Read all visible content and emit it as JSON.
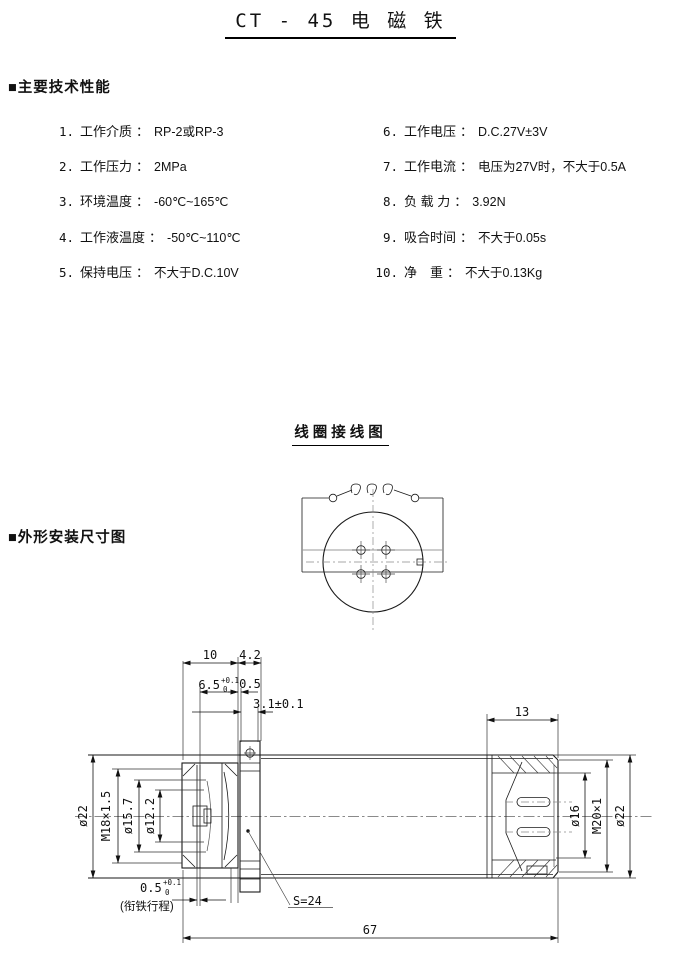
{
  "page": {
    "title": "CT - 45 电 磁 铁"
  },
  "headings": {
    "specs": "■主要技术性能",
    "coil": "线圈接线图",
    "outline": "■外形安装尺寸图"
  },
  "specs": {
    "colon": "：",
    "left": [
      {
        "num": "1.",
        "label": "工作介质",
        "value": "RP-2或RP-3"
      },
      {
        "num": "2.",
        "label": "工作压力",
        "value": "2MPa"
      },
      {
        "num": "3.",
        "label": "环境温度",
        "value": "-60℃~165℃"
      },
      {
        "num": "4.",
        "label": "工作液温度",
        "value": "-50℃~110℃"
      },
      {
        "num": "5.",
        "label": "保持电压",
        "value": "不大于D.C.10V"
      }
    ],
    "right": [
      {
        "num": "6.",
        "label": "工作电压",
        "value": "D.C.27V±3V"
      },
      {
        "num": "7.",
        "label": "工作电流",
        "value": "电压为27V时，不大于0.5A"
      },
      {
        "num": "8.",
        "label": "负 载 力",
        "value": "3.92N"
      },
      {
        "num": "9.",
        "label": "吸合时间",
        "value": "不大于0.05s"
      },
      {
        "num": "10.",
        "label": "净　重",
        "value": "不大于0.13Kg"
      }
    ]
  },
  "drawing": {
    "dims": {
      "len_10": "10",
      "len_42": "4.2",
      "len_65": "6.5",
      "len_65_tol_up": "+0.1",
      "len_65_tol_dn": "0",
      "len_05": "0.5",
      "len_31": "3.1±0.1",
      "len_13": "13",
      "dia_22_left": "ø22",
      "thread_m18": "M18×1.5",
      "dia_157": "ø15.7",
      "dia_122": "ø12.2",
      "dia_16": "ø16",
      "thread_m20": "M20×1",
      "dia_22_right": "ø22",
      "stroke_05": "0.5",
      "stroke_tol_up": "+0.1",
      "stroke_tol_dn": "0",
      "stroke_note": "(衔铁行程)",
      "hex_s24": "S=24",
      "len_67": "67"
    }
  }
}
